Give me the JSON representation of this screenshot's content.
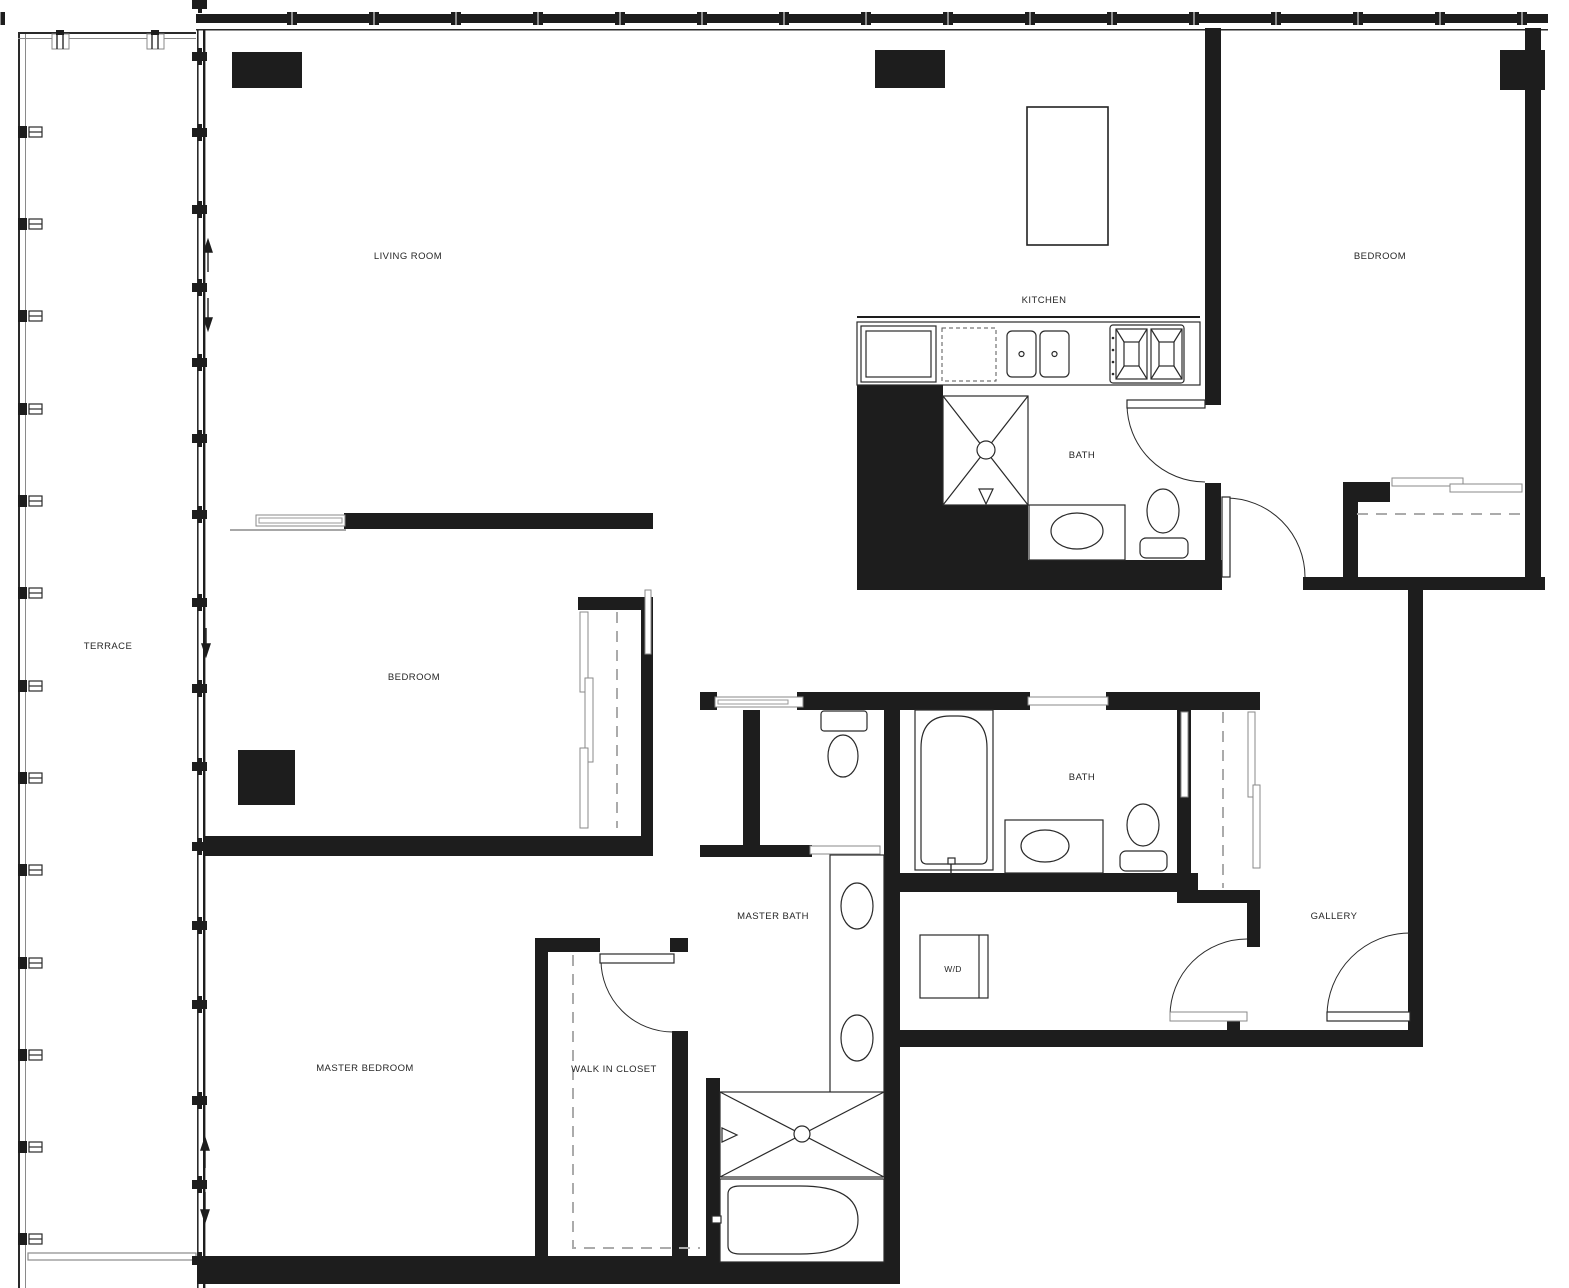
{
  "title": "Apartment floor plan",
  "rooms": {
    "terrace": {
      "label": "TERRACE"
    },
    "living_room": {
      "label": "LIVING ROOM"
    },
    "kitchen": {
      "label": "KITCHEN"
    },
    "bedroom_top_right": {
      "label": "BEDROOM"
    },
    "bath_upper": {
      "label": "BATH"
    },
    "bedroom_middle": {
      "label": "BEDROOM"
    },
    "master_bath": {
      "label": "MASTER BATH"
    },
    "bath_lower": {
      "label": "BATH"
    },
    "gallery": {
      "label": "GALLERY"
    },
    "laundry": {
      "label": "W/D"
    },
    "master_bedroom": {
      "label": "MASTER BEDROOM"
    },
    "walk_in_closet": {
      "label": "WALK IN CLOSET"
    }
  },
  "colors": {
    "wall": "#1d1d1d",
    "line": "#2a2a2a",
    "dash": "#ababab",
    "background": "#ffffff"
  },
  "fixtures": [
    "refrigerator-icon",
    "dishwasher-icon",
    "double-sink-icon",
    "cooktop-icon",
    "kitchen-island-icon",
    "shower-icon",
    "shower-head-icon",
    "floor-drain-icon",
    "toilet-icon",
    "vanity-sink-icon",
    "double-vanity-icon",
    "bathtub-icon",
    "washer-dryer-icon",
    "closet-rod-icon",
    "sliding-door-icon",
    "pocket-door-icon",
    "swing-door-icon",
    "window-mullion-icon",
    "column-icon",
    "direction-arrow-icon"
  ]
}
